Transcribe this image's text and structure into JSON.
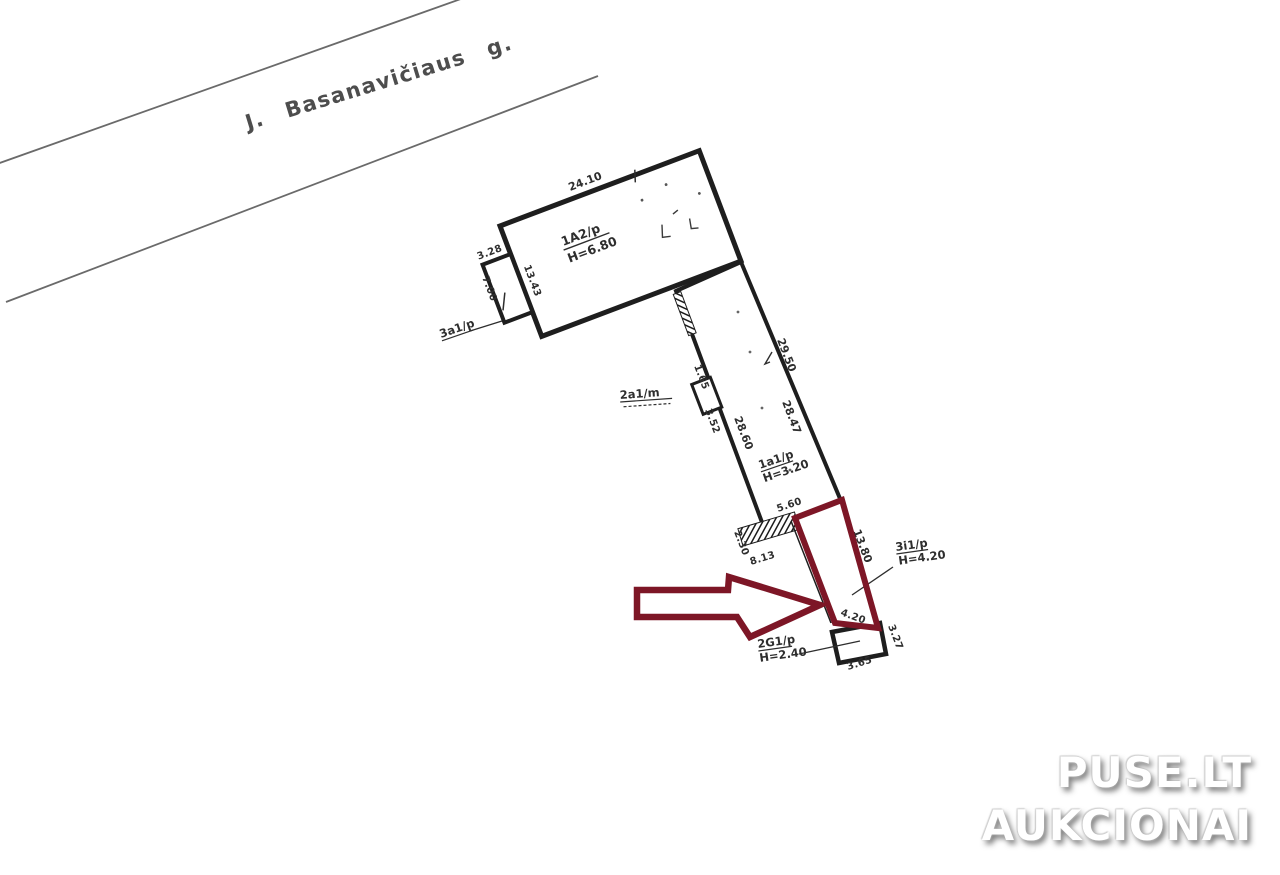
{
  "street": {
    "name": "J. Basanavičiaus g."
  },
  "units": {
    "main": {
      "label": "1A2/p",
      "height": "H=6.80"
    },
    "annex": {
      "label": "3a1/p"
    },
    "corridor": {
      "label": "1a1/p",
      "height": "H=3.20"
    },
    "mid": {
      "label": "2a1/m"
    },
    "highlighted": {
      "label": "3i1/p",
      "height": "H=4.20"
    },
    "garage": {
      "label": "2G1/p",
      "height": "H=2.40"
    }
  },
  "dims": {
    "main_top": "24.10",
    "annex_top": "3.28",
    "annex_left": "7.00",
    "main_left": "13.43",
    "mid_top": "1.65",
    "mid_bottom": "3.52",
    "corridor_left": "28.60",
    "corridor_right": "28.47",
    "corridor_right_upper": "29.50",
    "corridor_bottom": "5.60",
    "porch_left": "2.30",
    "porch_bottom": "8.13",
    "highlight_side": "13.80",
    "highlight_end": "4.20",
    "garage_right": "3.27",
    "garage_bottom": "3.65"
  },
  "watermark": {
    "line1": "PUSE.LT",
    "line2": "AUKCIONAI"
  },
  "colors": {
    "highlight": "#7d1626",
    "plan_line": "#1e1e1e",
    "street_line": "#6a6a6a",
    "text": "#2e2e2e"
  }
}
